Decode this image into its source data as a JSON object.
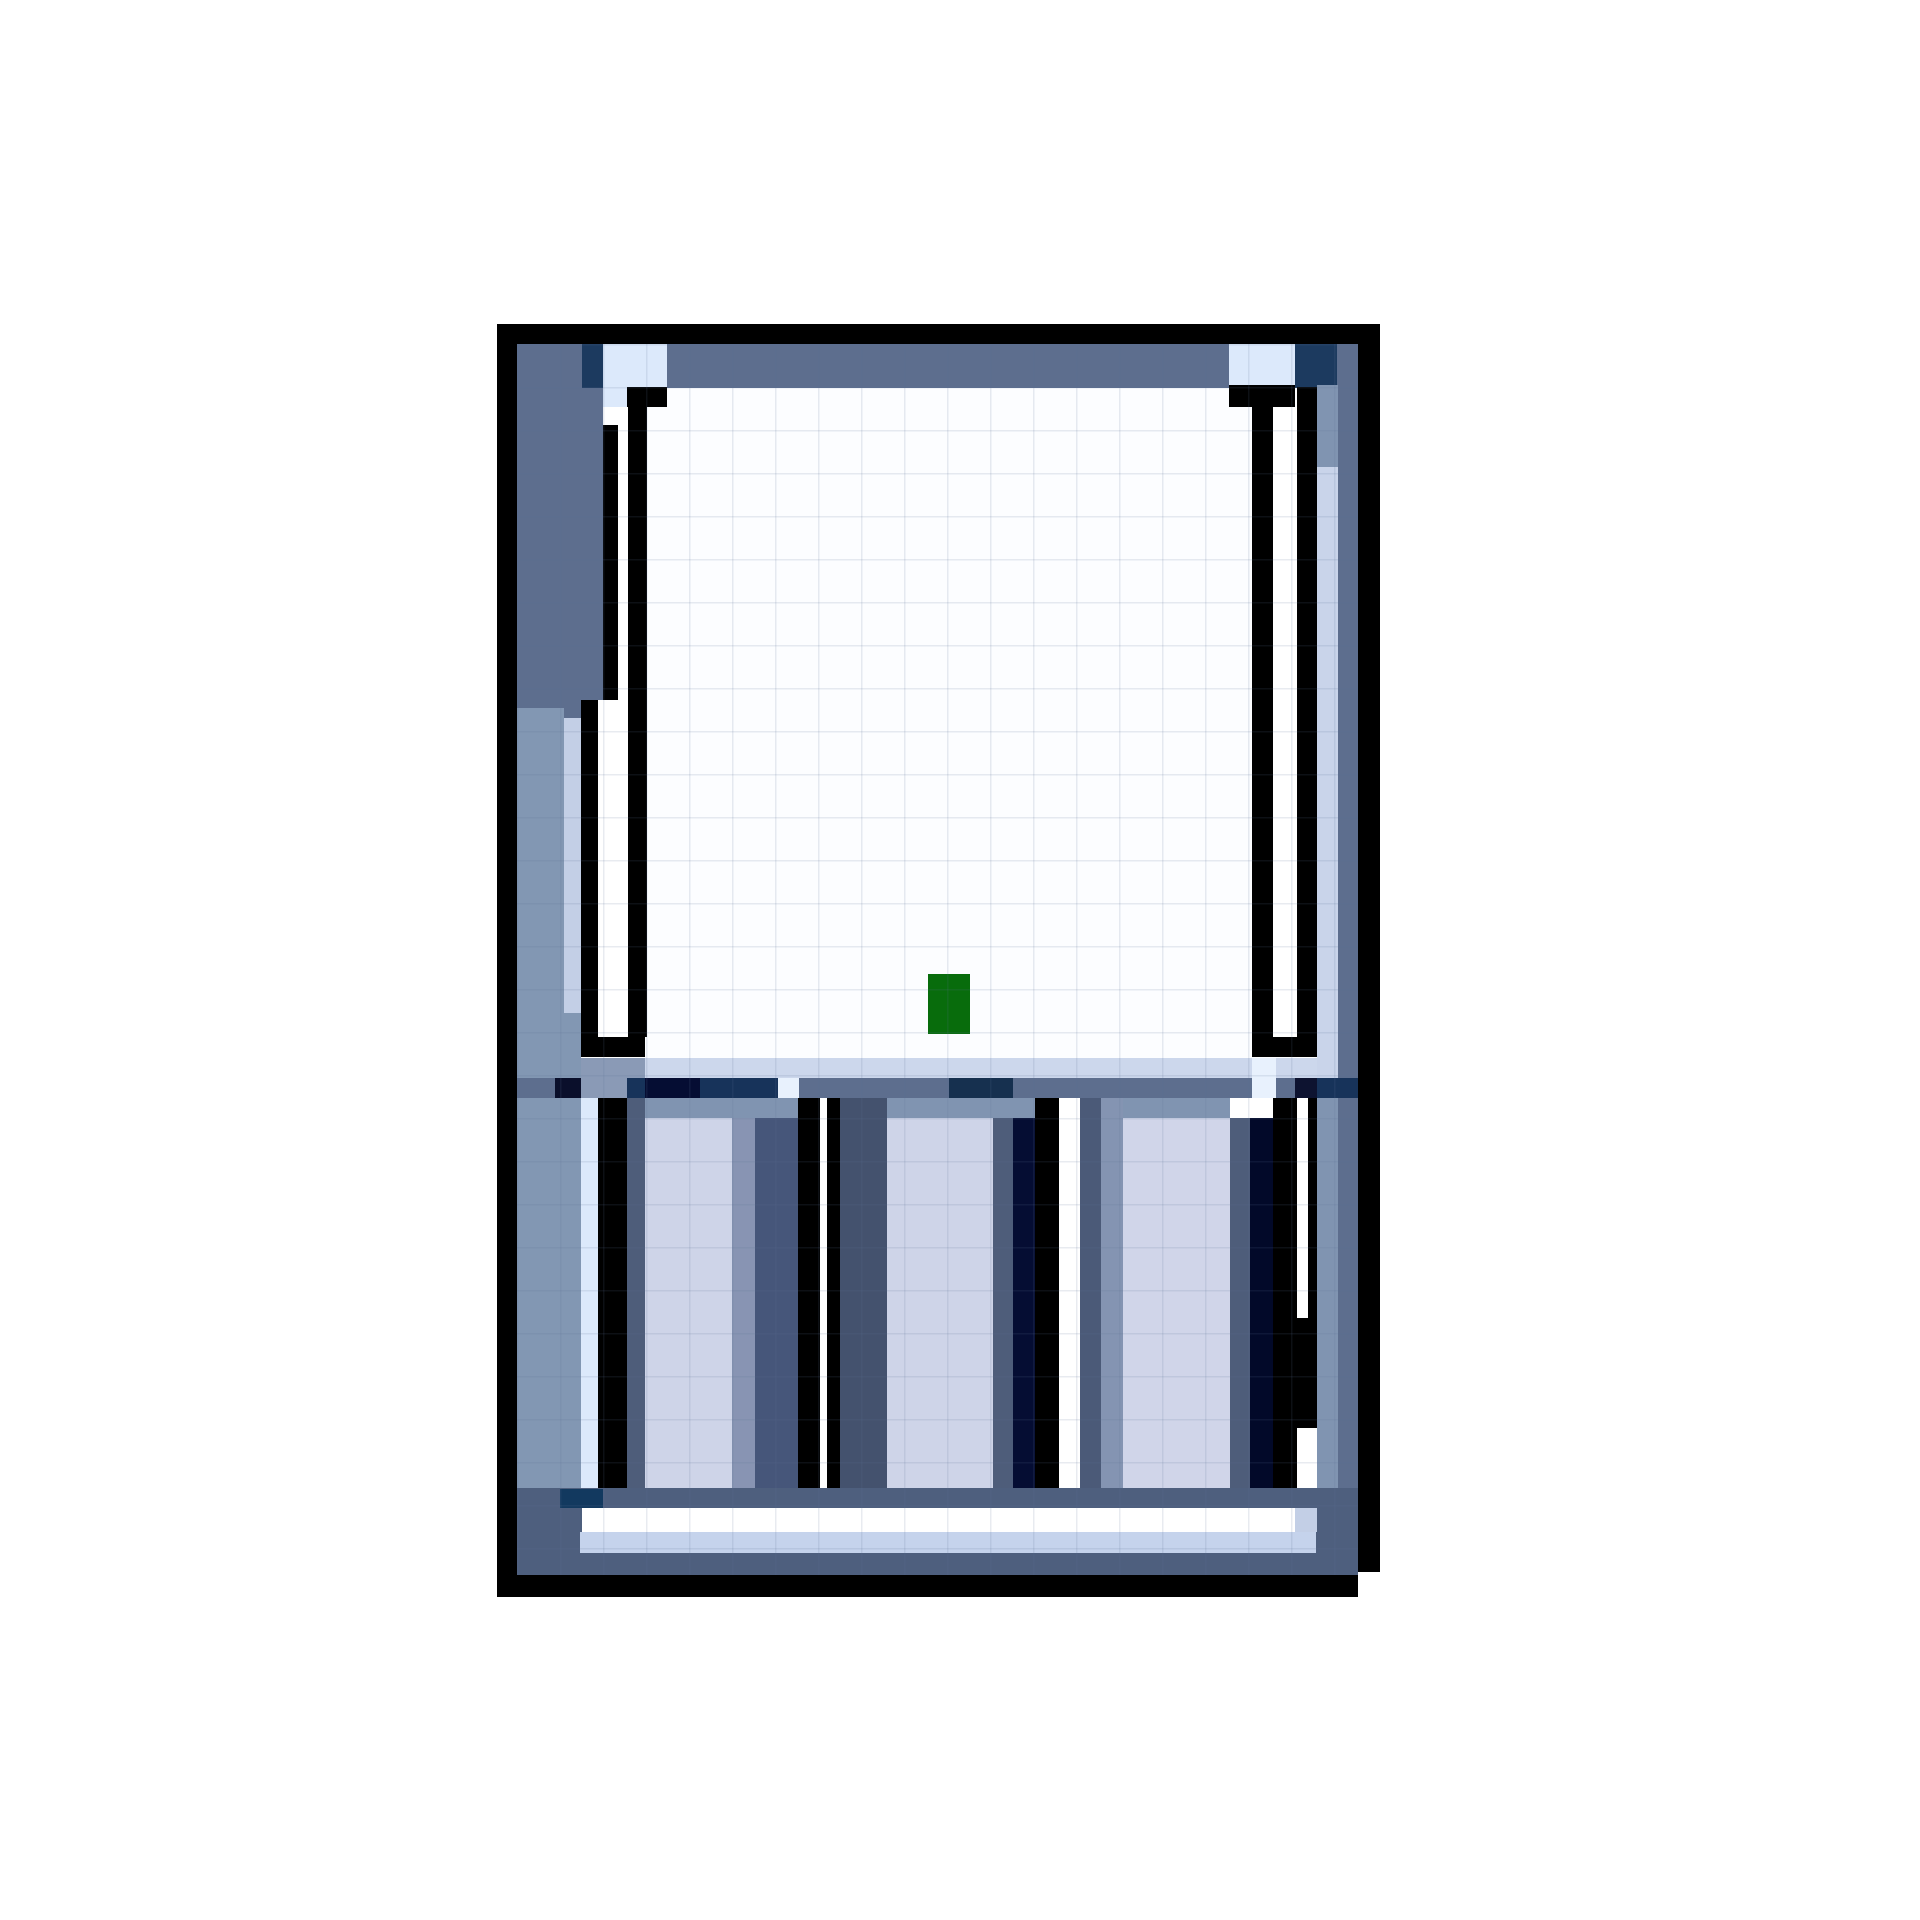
{
  "meta": {
    "canvas_width": 1920,
    "canvas_height": 1920,
    "background": "#ffffff",
    "subject": "pixel-art-battery-charger-sprite"
  },
  "palette": {
    "black": "#000000",
    "slate": "#5d6e8e",
    "baseSlate": "#4e5f7e",
    "slateMid": "#8094b1",
    "slateLight": "#8a9ab6",
    "steel": "#8297b3",
    "paleCol": "#c3cfe6",
    "paleStrip": "#c5d3ec",
    "paleR": "#c9d4ea",
    "paleBand": "#ccd7ec",
    "paleCell": "#dce9fb",
    "paleGlow": "#e8f1fd",
    "lavender": "#ced4e8",
    "lavender2": "#d0d5e9",
    "wallDark": "#4e5d7a",
    "wall2": "#44526e",
    "wall3": "#4b5a78",
    "medSlate": "#8894b3",
    "med2": "#8494b2",
    "darkCol": "#46567a",
    "navy": "#1c3a5f",
    "navy2": "#17335a",
    "navyDeep": "#16304f",
    "ink": "#0d1330",
    "ink2": "#050d33",
    "ink3": "#020929",
    "inkCell": "#0a0f2b",
    "navyBlock": "#12395f",
    "white": "#ffffff",
    "windowWhite": "#fcfdff",
    "green": "#086c0c"
  },
  "grid_overlay": {
    "x": 517,
    "y": 344,
    "w": 841,
    "h": 1231,
    "step": 43,
    "line_thickness": 1.5,
    "color": "rgba(90,110,150,0.14)"
  },
  "art": {
    "rects": [
      {
        "x": 497,
        "y": 324,
        "w": 883,
        "h": 20,
        "c": "black",
        "name": "outer-border-top"
      },
      {
        "x": 497,
        "y": 324,
        "w": 20,
        "h": 1273,
        "c": "black",
        "name": "outer-border-left"
      },
      {
        "x": 1358,
        "y": 324,
        "w": 22,
        "h": 1248,
        "c": "black",
        "name": "outer-border-right"
      },
      {
        "x": 497,
        "y": 1575,
        "w": 861,
        "h": 22,
        "c": "black",
        "name": "outer-border-bottom"
      },
      {
        "x": 1338,
        "y": 1553,
        "w": 20,
        "h": 22,
        "c": "black",
        "name": "corner-step"
      },
      {
        "x": 517,
        "y": 344,
        "w": 841,
        "h": 44,
        "c": "slate",
        "name": "top-frame-band"
      },
      {
        "x": 582,
        "y": 344,
        "w": 21,
        "h": 44,
        "c": "navy",
        "name": "top-band-navy-left"
      },
      {
        "x": 603,
        "y": 344,
        "w": 64,
        "h": 44,
        "c": "paleCell",
        "name": "top-band-highlight-left"
      },
      {
        "x": 1229,
        "y": 344,
        "w": 66,
        "h": 44,
        "c": "paleCell",
        "name": "top-band-highlight-right"
      },
      {
        "x": 1295,
        "y": 344,
        "w": 42,
        "h": 44,
        "c": "navy",
        "name": "top-band-navy-right"
      },
      {
        "x": 517,
        "y": 388,
        "w": 47,
        "h": 320,
        "c": "slate",
        "name": "left-frame-column-upper"
      },
      {
        "x": 517,
        "y": 708,
        "w": 47,
        "h": 780,
        "c": "steel",
        "name": "left-frame-column-lower"
      },
      {
        "x": 564,
        "y": 388,
        "w": 17,
        "h": 330,
        "c": "slate"
      },
      {
        "x": 564,
        "y": 718,
        "w": 17,
        "h": 295,
        "c": "paleCol",
        "name": "left-inner-highlight-column"
      },
      {
        "x": 564,
        "y": 1013,
        "w": 17,
        "h": 475,
        "c": "steel"
      },
      {
        "x": 581,
        "y": 388,
        "w": 22,
        "h": 312,
        "c": "slate"
      },
      {
        "x": 1338,
        "y": 388,
        "w": 20,
        "h": 1165,
        "c": "slate",
        "name": "right-frame-column"
      },
      {
        "x": 1317,
        "y": 385,
        "w": 21,
        "h": 82,
        "c": "slateMid"
      },
      {
        "x": 1317,
        "y": 467,
        "w": 21,
        "h": 1041,
        "c": "paleR",
        "name": "right-inner-highlight-column"
      },
      {
        "x": 645,
        "y": 388,
        "w": 652,
        "h": 670,
        "c": "windowWhite",
        "name": "screen-window"
      },
      {
        "x": 603,
        "y": 388,
        "w": 24,
        "h": 19,
        "c": "paleCell"
      },
      {
        "x": 627,
        "y": 387,
        "w": 40,
        "h": 20,
        "c": "black",
        "name": "left-frame-cap-top"
      },
      {
        "x": 628,
        "y": 387,
        "w": 19,
        "h": 650,
        "c": "black",
        "name": "left-frame-line"
      },
      {
        "x": 618,
        "y": 407,
        "w": 10,
        "h": 293,
        "c": "white"
      },
      {
        "x": 603,
        "y": 425,
        "w": 15,
        "h": 275,
        "c": "black"
      },
      {
        "x": 581,
        "y": 700,
        "w": 17,
        "h": 337,
        "c": "black"
      },
      {
        "x": 598,
        "y": 700,
        "w": 30,
        "h": 337,
        "c": "white"
      },
      {
        "x": 581,
        "y": 1037,
        "w": 64,
        "h": 20,
        "c": "black",
        "name": "left-frame-cap-bottom"
      },
      {
        "x": 1229,
        "y": 385,
        "w": 66,
        "h": 22,
        "c": "black",
        "name": "right-frame-cap-top"
      },
      {
        "x": 1297,
        "y": 387,
        "w": 20,
        "h": 650,
        "c": "black",
        "name": "right-frame-line"
      },
      {
        "x": 1273,
        "y": 407,
        "w": 24,
        "h": 630,
        "c": "white"
      },
      {
        "x": 1252,
        "y": 407,
        "w": 21,
        "h": 630,
        "c": "black"
      },
      {
        "x": 1252,
        "y": 1037,
        "w": 65,
        "h": 20,
        "c": "black",
        "name": "right-frame-cap-bottom"
      },
      {
        "x": 928,
        "y": 974,
        "w": 42,
        "h": 60,
        "c": "green",
        "name": "led-indicator"
      },
      {
        "x": 581,
        "y": 1058,
        "w": 736,
        "h": 20,
        "c": "paleBand",
        "name": "mid-highlight-band"
      },
      {
        "x": 581,
        "y": 1058,
        "w": 64,
        "h": 20,
        "c": "slateLight"
      },
      {
        "x": 1252,
        "y": 1058,
        "w": 24,
        "h": 20,
        "c": "paleGlow"
      },
      {
        "x": 517,
        "y": 1078,
        "w": 841,
        "h": 20,
        "c": "slate",
        "name": "mid-dark-band"
      },
      {
        "x": 555,
        "y": 1078,
        "w": 26,
        "h": 20,
        "c": "inkCell"
      },
      {
        "x": 581,
        "y": 1078,
        "w": 46,
        "h": 20,
        "c": "slateLight"
      },
      {
        "x": 627,
        "y": 1078,
        "w": 18,
        "h": 20,
        "c": "navy2"
      },
      {
        "x": 645,
        "y": 1078,
        "w": 55,
        "h": 20,
        "c": "ink2"
      },
      {
        "x": 700,
        "y": 1078,
        "w": 78,
        "h": 20,
        "c": "navy2"
      },
      {
        "x": 778,
        "y": 1078,
        "w": 21,
        "h": 20,
        "c": "paleGlow"
      },
      {
        "x": 949,
        "y": 1078,
        "w": 64,
        "h": 20,
        "c": "navyDeep"
      },
      {
        "x": 1252,
        "y": 1078,
        "w": 24,
        "h": 20,
        "c": "paleGlow"
      },
      {
        "x": 1295,
        "y": 1078,
        "w": 22,
        "h": 20,
        "c": "ink"
      },
      {
        "x": 1317,
        "y": 1078,
        "w": 41,
        "h": 20,
        "c": "navy2"
      },
      {
        "x": 581,
        "y": 1098,
        "w": 17,
        "h": 390,
        "c": "paleCell",
        "name": "slot1-left-highlight"
      },
      {
        "x": 598,
        "y": 1098,
        "w": 29,
        "h": 390,
        "c": "black",
        "name": "slot1-line-left"
      },
      {
        "x": 627,
        "y": 1098,
        "w": 18,
        "h": 410,
        "c": "wallDark"
      },
      {
        "x": 645,
        "y": 1098,
        "w": 153,
        "h": 20,
        "c": "slateMid"
      },
      {
        "x": 645,
        "y": 1118,
        "w": 87,
        "h": 370,
        "c": "lavender",
        "name": "slot1-body"
      },
      {
        "x": 732,
        "y": 1118,
        "w": 23,
        "h": 370,
        "c": "medSlate"
      },
      {
        "x": 755,
        "y": 1118,
        "w": 43,
        "h": 370,
        "c": "darkCol"
      },
      {
        "x": 798,
        "y": 1098,
        "w": 22,
        "h": 390,
        "c": "black",
        "name": "slot1-line-right"
      },
      {
        "x": 820,
        "y": 1098,
        "w": 7,
        "h": 390,
        "c": "white"
      },
      {
        "x": 827,
        "y": 1098,
        "w": 13,
        "h": 390,
        "c": "black",
        "name": "slot2-line-left"
      },
      {
        "x": 840,
        "y": 1098,
        "w": 47,
        "h": 410,
        "c": "wall2"
      },
      {
        "x": 887,
        "y": 1098,
        "w": 106,
        "h": 20,
        "c": "slateMid"
      },
      {
        "x": 887,
        "y": 1118,
        "w": 106,
        "h": 370,
        "c": "lavender",
        "name": "slot2-body"
      },
      {
        "x": 993,
        "y": 1098,
        "w": 42,
        "h": 20,
        "c": "slateMid"
      },
      {
        "x": 993,
        "y": 1118,
        "w": 20,
        "h": 370,
        "c": "wallDark"
      },
      {
        "x": 1013,
        "y": 1118,
        "w": 22,
        "h": 370,
        "c": "ink2"
      },
      {
        "x": 1035,
        "y": 1098,
        "w": 24,
        "h": 390,
        "c": "black",
        "name": "slot2-line-right"
      },
      {
        "x": 1059,
        "y": 1098,
        "w": 21,
        "h": 390,
        "c": "white",
        "name": "slot-divider-gap"
      },
      {
        "x": 1080,
        "y": 1098,
        "w": 21,
        "h": 410,
        "c": "wall3"
      },
      {
        "x": 1101,
        "y": 1098,
        "w": 22,
        "h": 410,
        "c": "med2"
      },
      {
        "x": 1123,
        "y": 1098,
        "w": 107,
        "h": 20,
        "c": "slateMid"
      },
      {
        "x": 1123,
        "y": 1118,
        "w": 107,
        "h": 370,
        "c": "lavender2",
        "name": "slot3-body"
      },
      {
        "x": 1230,
        "y": 1118,
        "w": 20,
        "h": 370,
        "c": "wallDark"
      },
      {
        "x": 1250,
        "y": 1118,
        "w": 23,
        "h": 370,
        "c": "ink3"
      },
      {
        "x": 1273,
        "y": 1098,
        "w": 24,
        "h": 412,
        "c": "black",
        "name": "slot3-line-right"
      },
      {
        "x": 1297,
        "y": 1098,
        "w": 11,
        "h": 220,
        "c": "white"
      },
      {
        "x": 1308,
        "y": 1098,
        "w": 9,
        "h": 220,
        "c": "black"
      },
      {
        "x": 1297,
        "y": 1318,
        "w": 21,
        "h": 110,
        "c": "black"
      },
      {
        "x": 1317,
        "y": 1098,
        "w": 21,
        "h": 390,
        "c": "slateMid",
        "name": "slot4-column"
      },
      {
        "x": 517,
        "y": 1488,
        "w": 841,
        "h": 87,
        "c": "baseSlate",
        "name": "base-band"
      },
      {
        "x": 560,
        "y": 1489,
        "w": 43,
        "h": 19,
        "c": "navyBlock",
        "name": "base-navy-accent"
      },
      {
        "x": 582,
        "y": 1508,
        "w": 735,
        "h": 24,
        "c": "white",
        "name": "base-white-strip"
      },
      {
        "x": 1295,
        "y": 1508,
        "w": 22,
        "h": 24,
        "c": "paleCol"
      },
      {
        "x": 580,
        "y": 1532,
        "w": 736,
        "h": 21,
        "c": "paleStrip",
        "name": "base-pale-strip"
      }
    ]
  }
}
